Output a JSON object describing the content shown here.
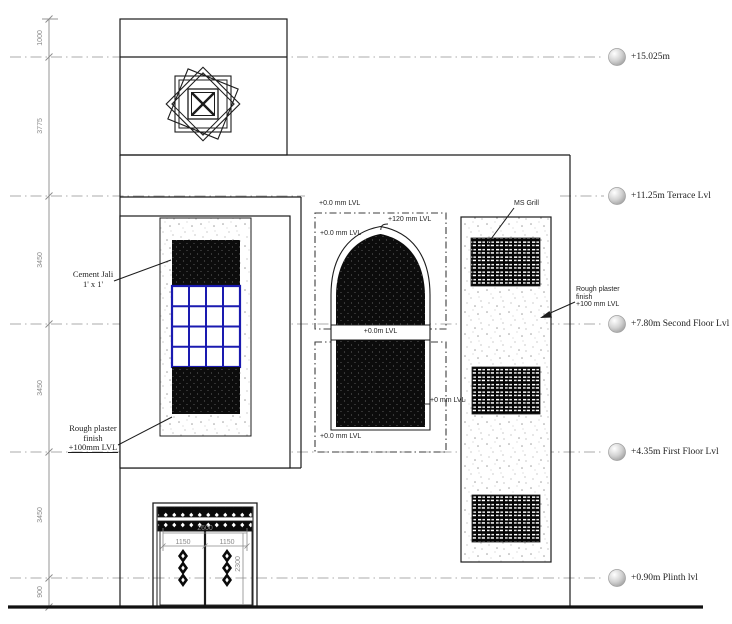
{
  "drawing": {
    "title": "Front Elevation",
    "levels": [
      {
        "label": "+15.025m"
      },
      {
        "label": "+11.25m Terrace Lvl"
      },
      {
        "label": "+7.80m Second Floor Lvl"
      },
      {
        "label": "+4.35m First Floor Lvl"
      },
      {
        "label": "+0.90m Plinth lvl"
      }
    ],
    "left_dims": [
      {
        "value": "1000"
      },
      {
        "value": "3775"
      },
      {
        "value": "3450"
      },
      {
        "value": "3450"
      },
      {
        "value": "3450"
      },
      {
        "value": "900"
      }
    ],
    "door_dims": {
      "overall": "2600",
      "leaf_left": "1150",
      "leaf_right": "1150",
      "height": "2300"
    },
    "annotations": {
      "cement_jali": {
        "line1": "Cement Jali",
        "line2": "1' x 1'"
      },
      "plaster_left": {
        "line1": "Rough plaster",
        "line2": "finish",
        "line3": "+100mm LVL"
      },
      "plaster_right": {
        "line1": "Rough plaster",
        "line2": "finish",
        "line3": "+100 mm LVL"
      },
      "ms_grill": "MS Grill",
      "arch": {
        "top": "+0.0 mm LVL",
        "upper": "+0.0 mm LVL",
        "apex": "+120 mm LVL",
        "band": "+0.0m LVL",
        "sill": "+0 mm LVL",
        "bottom": "+0.0 mm LVL"
      }
    },
    "colors": {
      "line": "#1c1c1c",
      "dim": "#8a8a8a",
      "level_line": "#ababab",
      "jali_blue": "#1a1ab0"
    }
  }
}
